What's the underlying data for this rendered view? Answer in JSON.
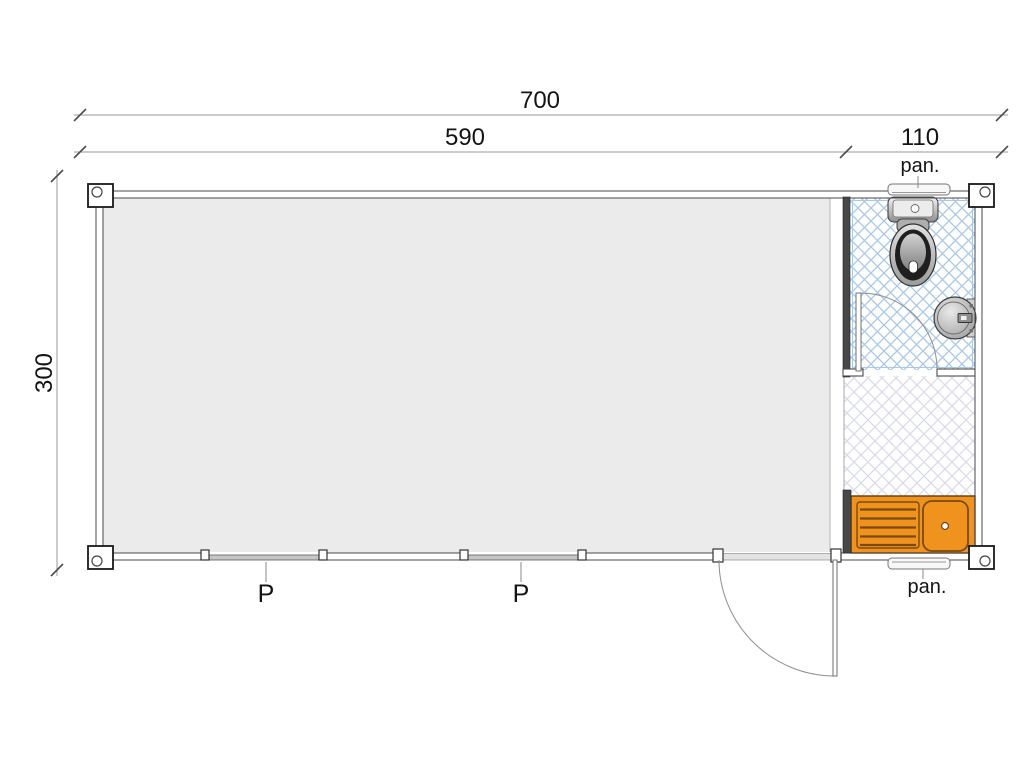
{
  "dimensions": {
    "overall_width": "700",
    "main_module_width": "590",
    "sanitary_module_width": "110",
    "overall_depth": "300"
  },
  "labels": {
    "panel_window_top": "pan.",
    "panel_window_bottom": "pan.",
    "window_left": "P",
    "window_right": "P"
  },
  "colors": {
    "kitchen_counter": "#F0921E",
    "counter_detail": "#7A4A10",
    "bathroom_tile_hatch": "#A9C8E6",
    "kitchenette_hatch": "#DADAEB",
    "main_room_floor": "#EBEBEB"
  },
  "icons": {
    "toilet": "toilet-icon",
    "wash_basin": "wash-basin-icon",
    "kitchen_sink": "kitchen-sink-icon"
  }
}
